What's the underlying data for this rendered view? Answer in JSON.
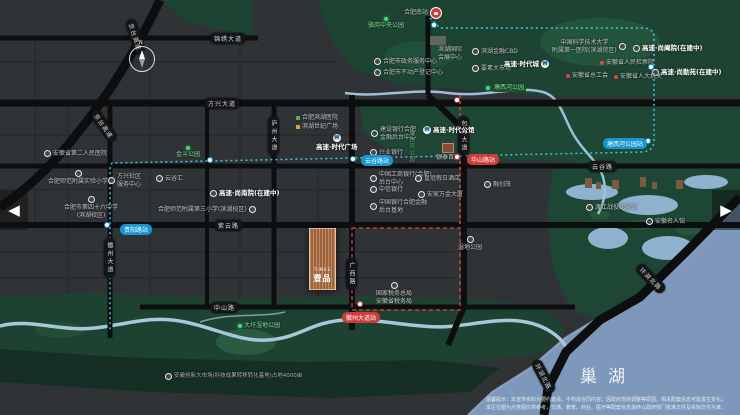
{
  "map": {
    "compass": "N",
    "lake_name": "巢湖",
    "project_logo": {
      "en": "TIMES",
      "cn": "壹品"
    },
    "nav": {
      "prev": "◀",
      "next": "▶"
    },
    "disclaimer": {
      "line1": "温馨提示：本宣传资料为要约邀请，不构成合同内容；因政府规划调整等原因，相关配套信息可能发生变化；",
      "line2": "本区位图为示意图仅供参考，交通、教育、商业、医疗等配套信息最终以政府部门批准文件及实际交付为准。"
    }
  },
  "pois": [
    {
      "text": "合肥南站"
    },
    {
      "text": "骆岗中央公园"
    },
    {
      "text": "塘西河公园"
    },
    {
      "text": "合肥市政务服务中心"
    },
    {
      "text": "合肥市不动产登记中心"
    },
    {
      "text": "滨湖国际\n会展中心"
    },
    {
      "text": "滨湖金融CBD"
    },
    {
      "text": "要素大市场"
    },
    {
      "text": "高速·时代城"
    },
    {
      "text": "中国科学技术大学\n附属第一医院(滨湖院区)"
    },
    {
      "text": "高速·尚阖院(在建中)"
    },
    {
      "text": "高速·尚勤苑(在建中)"
    },
    {
      "text": "安徽省人民检察院"
    },
    {
      "text": "安徽省总工会"
    },
    {
      "text": "安徽省人大机关"
    },
    {
      "text": "高速·时代广场"
    },
    {
      "text": "高速·时代公馆"
    },
    {
      "text": "建设银行合肥\n金融后台中心"
    },
    {
      "text": "兴业银行"
    },
    {
      "text": "中国工商银行(合肥)\n后台中心"
    },
    {
      "text": "中信银行"
    },
    {
      "text": "中国银行合肥金融\n后台基地"
    },
    {
      "text": "皇冠假日酒店"
    },
    {
      "text": "安家万金大厦"
    },
    {
      "text": "银泰百货"
    },
    {
      "text": "融创茂"
    },
    {
      "text": "合肥滨湖医院"
    },
    {
      "text": "滨湖世纪广场"
    },
    {
      "text": "金斗公园"
    },
    {
      "text": "云谷汇"
    },
    {
      "text": "方兴社区\n服务中心"
    },
    {
      "text": "安徽省第二人民医院"
    },
    {
      "text": "合肥师范附属实验小学"
    },
    {
      "text": "合肥市第四十六中学\n(滨湖校区)"
    },
    {
      "text": "高速·尚南院(在建中)"
    },
    {
      "text": "合肥师范附属第三小学(滨湖校区)"
    },
    {
      "text": "国家税务总局\n安徽省税务局"
    },
    {
      "text": "湿地公园"
    },
    {
      "text": "大圩湿地公园"
    },
    {
      "text": "安徽创新大市场(科技成果转移转化基地)占地4000亩"
    },
    {
      "text": "渡江战役纪念馆"
    },
    {
      "text": "安徽名人馆"
    },
    {
      "text": "塘西河公园"
    }
  ],
  "road_pills": [
    "锦绣大道",
    "方兴大道",
    "云谷路",
    "紫云路",
    "中山路",
    "徽州大道",
    "庐州大道",
    "包河大道",
    "广西路",
    "京台高速",
    "京台高速",
    "环湖北路",
    "环湖北路"
  ],
  "stations": {
    "teal": [
      "贵阳路站",
      "云谷路站",
      "塘西河公园站"
    ],
    "red": [
      "华山路站",
      "徽州大道站"
    ]
  }
}
